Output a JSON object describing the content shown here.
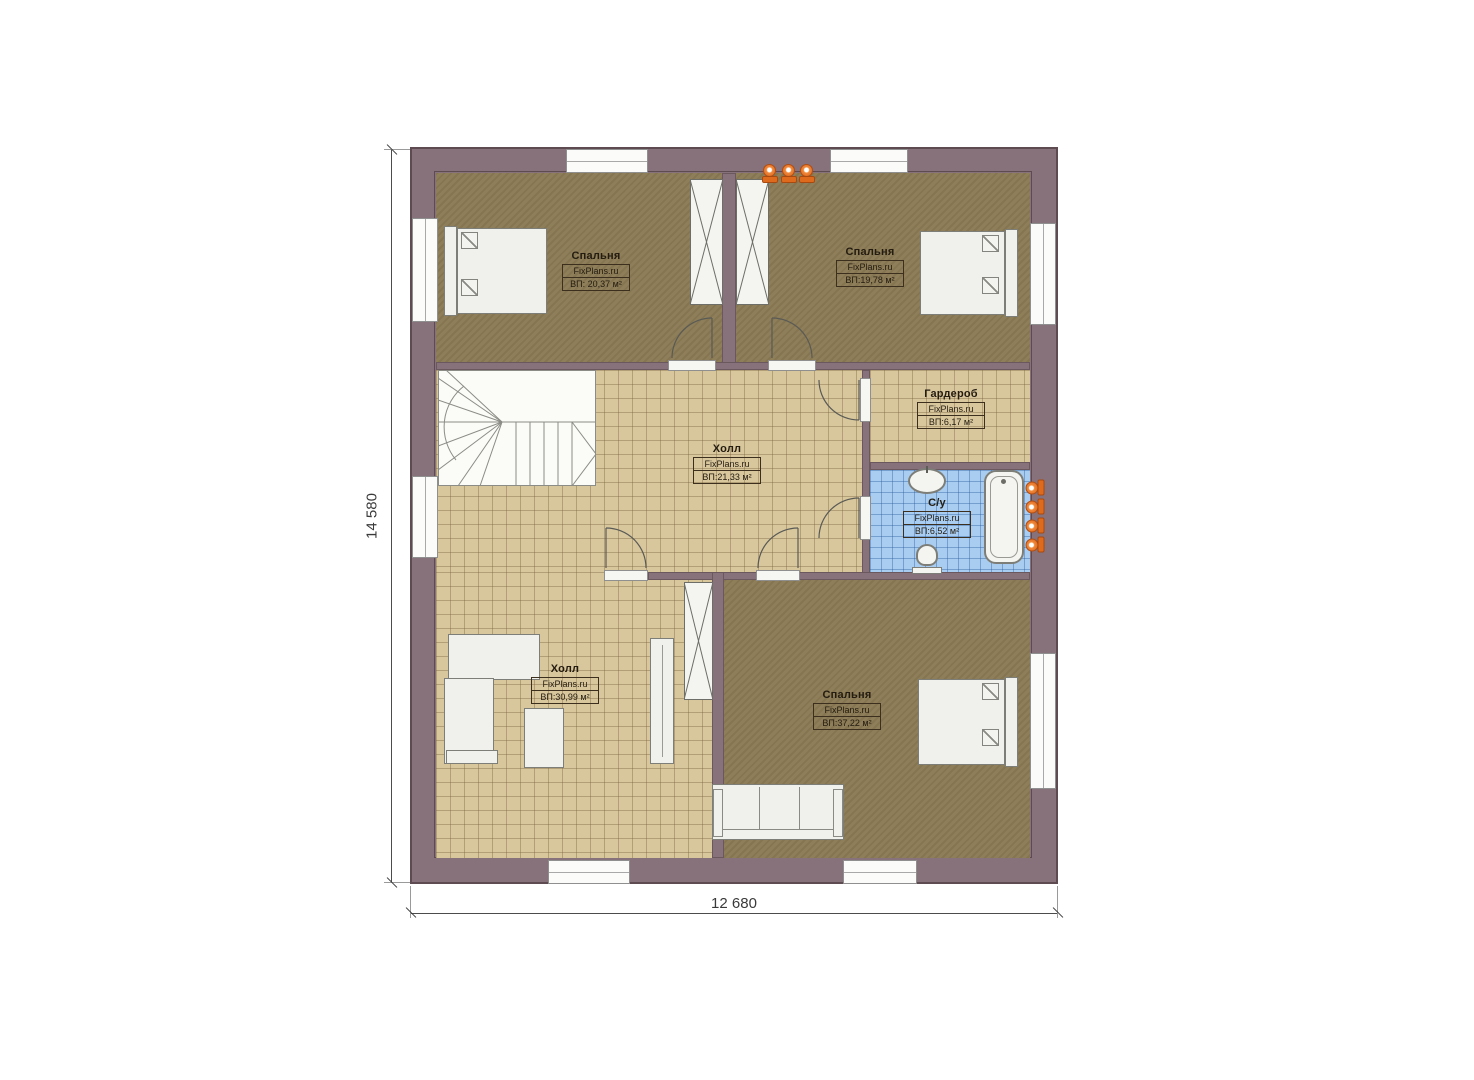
{
  "brand": "FixPlans.ru",
  "dimensions": {
    "height_label": "14 580",
    "width_label": "12 680"
  },
  "rooms": [
    {
      "id": "bedroom-top-left",
      "name": "Спальня",
      "brand": "FixPlans.ru",
      "area": "ВП: 20,37 м²"
    },
    {
      "id": "bedroom-top-right",
      "name": "Спальня",
      "brand": "FixPlans.ru",
      "area": "ВП:19,78 м²"
    },
    {
      "id": "wardrobe",
      "name": "Гардероб",
      "brand": "FixPlans.ru",
      "area": "ВП:6,17 м²"
    },
    {
      "id": "hall-center",
      "name": "Холл",
      "brand": "FixPlans.ru",
      "area": "ВП:21,33 м²"
    },
    {
      "id": "bathroom",
      "name": "С/у",
      "brand": "FixPlans.ru",
      "area": "ВП:6,52 м²"
    },
    {
      "id": "hall-lower",
      "name": "Холл",
      "brand": "FixPlans.ru",
      "area": "ВП:30,99 м²"
    },
    {
      "id": "bedroom-bottom",
      "name": "Спальня",
      "brand": "FixPlans.ru",
      "area": "ВП:37,22 м²"
    }
  ],
  "colors": {
    "wall": "#87717a",
    "wood_floor": "#8a7a54",
    "tile_floor": "#d8c79d",
    "bath_floor": "#a9cdf1",
    "sconce": "#e8772b"
  },
  "icons": [
    {
      "name": "sconce-icon",
      "shape": "orange circle with base"
    },
    {
      "name": "door-arc",
      "shape": "quarter-circle door swing"
    },
    {
      "name": "closet-x-icon",
      "shape": "rectangle with X"
    }
  ]
}
